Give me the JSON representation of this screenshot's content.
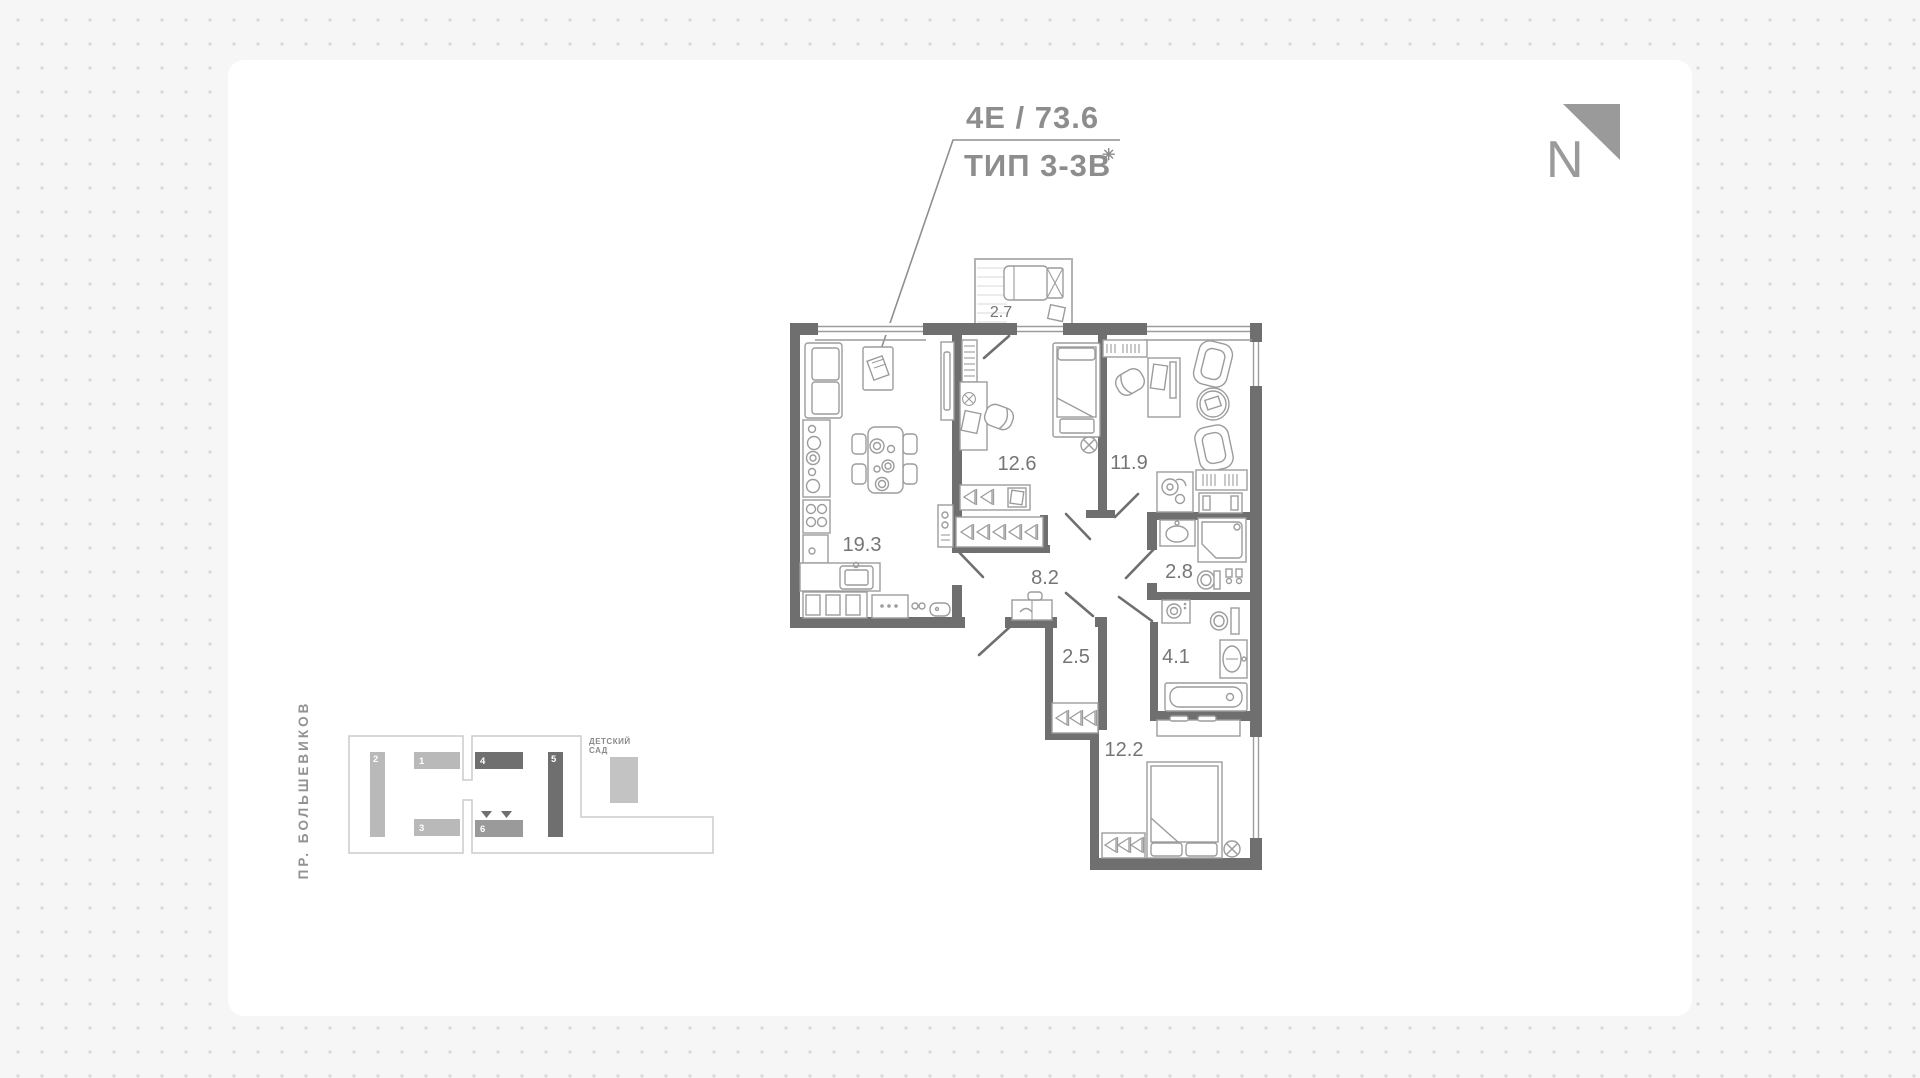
{
  "header": {
    "unit_line": "4Е /  73.6",
    "type_line": "ТИП 3-3В",
    "type_mark": "✳",
    "north_letter": "N"
  },
  "plan": {
    "rooms": [
      {
        "name": "balcony",
        "area": "2.7"
      },
      {
        "name": "kitchen-living",
        "area": "19.3"
      },
      {
        "name": "bedroom-1",
        "area": "12.6"
      },
      {
        "name": "bedroom-2",
        "area": "11.9"
      },
      {
        "name": "hallway",
        "area": "8.2"
      },
      {
        "name": "bathroom-1",
        "area": "2.8"
      },
      {
        "name": "wardrobe-hall",
        "area": "2.5"
      },
      {
        "name": "bathroom-2",
        "area": "4.1"
      },
      {
        "name": "bedroom-3",
        "area": "12.2"
      }
    ]
  },
  "site": {
    "street": "ПР. БОЛЬШЕВИКОВ",
    "kindergarten_lines": [
      "ДЕТСКИЙ",
      "САД"
    ],
    "buildings": [
      "1",
      "2",
      "3",
      "4",
      "5",
      "6"
    ]
  },
  "colors": {
    "wall": "#6f6f6f",
    "furniture": "#9c9c9c",
    "label": "#757575",
    "building_light": "#b9b9b9",
    "building_dark": "#6f6f6f",
    "dot": "#d9d9d9"
  }
}
